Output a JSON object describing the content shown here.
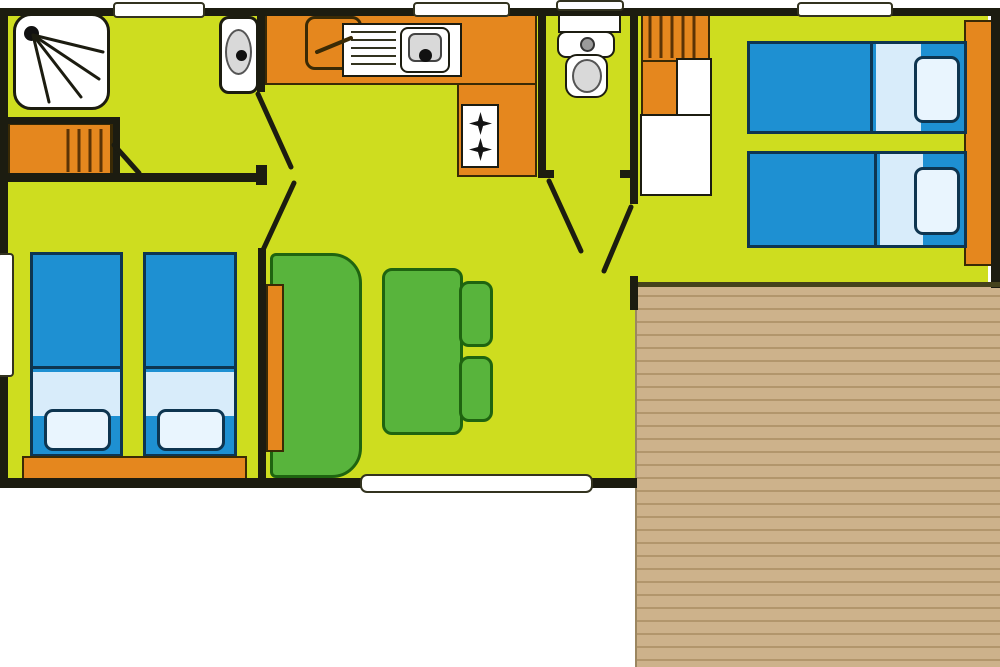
{
  "title": "Mobile home floor plan",
  "palette": {
    "floor": "#cedd1f",
    "wall": "#1c1c10",
    "wallThin": "#45421c",
    "orange": "#e5871e",
    "orangeLine": "#3a2a05",
    "blue": "#1e90d2",
    "blueLight": "#d8ecfa",
    "pillowFill": "#e9f5fe",
    "bedLine": "#0e3550",
    "green": "#58b43c",
    "greenLine": "#1f6410",
    "white": "#ffffff",
    "lineGray": "#33331f",
    "basinGray": "#d9d9d9",
    "terraceBase": "#cdb28b",
    "terracePlank": "#b2966c"
  },
  "rooms": [
    {
      "name": "bathroom",
      "furniture": [
        "shower",
        "wardrobe",
        "washbasin"
      ]
    },
    {
      "name": "kitchen",
      "furniture": [
        "counter",
        "fridge",
        "sink-with-drainer",
        "stove-two-burners"
      ]
    },
    {
      "name": "wc",
      "furniture": [
        "toilet"
      ]
    },
    {
      "name": "bedroom-right",
      "furniture": [
        "single-bed",
        "single-bed",
        "wardrobe",
        "closet",
        "headboard-shelf"
      ]
    },
    {
      "name": "bedroom-left",
      "furniture": [
        "single-bed",
        "single-bed",
        "foot-shelf"
      ]
    },
    {
      "name": "living-room",
      "furniture": [
        "sofa-bench",
        "dining-table",
        "stool",
        "stool"
      ]
    },
    {
      "name": "terrace",
      "furniture": [
        "wood-decking"
      ]
    }
  ],
  "openings": {
    "windows": [
      "top-bathroom",
      "top-kitchen",
      "top-wc",
      "top-bedroom-right",
      "left-bedroom",
      "bottom-living-bay"
    ],
    "doors": [
      "bathroom-door",
      "hall-door-a",
      "hall-door-b",
      "wc-door",
      "bedroom-right-door"
    ]
  }
}
